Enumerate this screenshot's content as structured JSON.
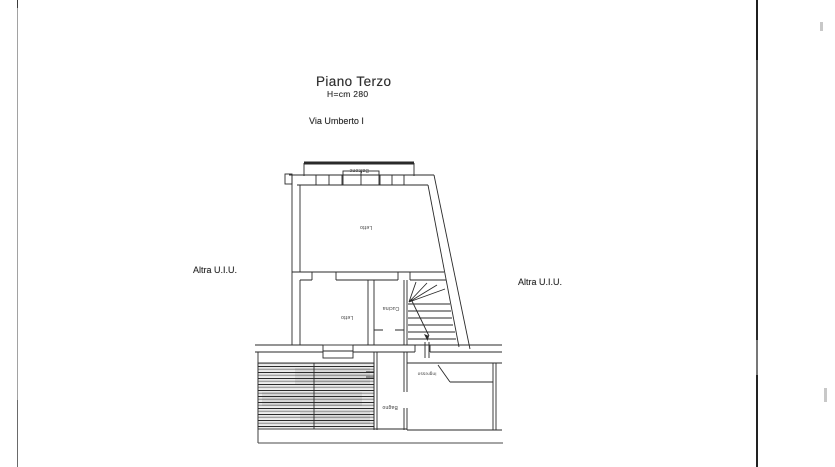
{
  "document": {
    "title": "Piano Terzo",
    "height_note": "H=cm 280",
    "street_label": "Via Umberto I",
    "adjacent_unit_left": "Altra U.I.U.",
    "adjacent_unit_right": "Altra U.I.U."
  },
  "floor_plan": {
    "room_labels": {
      "balcony": "Balcone",
      "main_room": "Letto",
      "bedroom": "Letto",
      "kitchen": "Cucina",
      "bathroom": "Bagno",
      "entry": "Ingresso"
    }
  },
  "colors": {
    "ink": "#2a2a2a",
    "page_background": "#ffffff",
    "fold_line": "#303030",
    "page_edge_line": "#9b9b9b"
  }
}
